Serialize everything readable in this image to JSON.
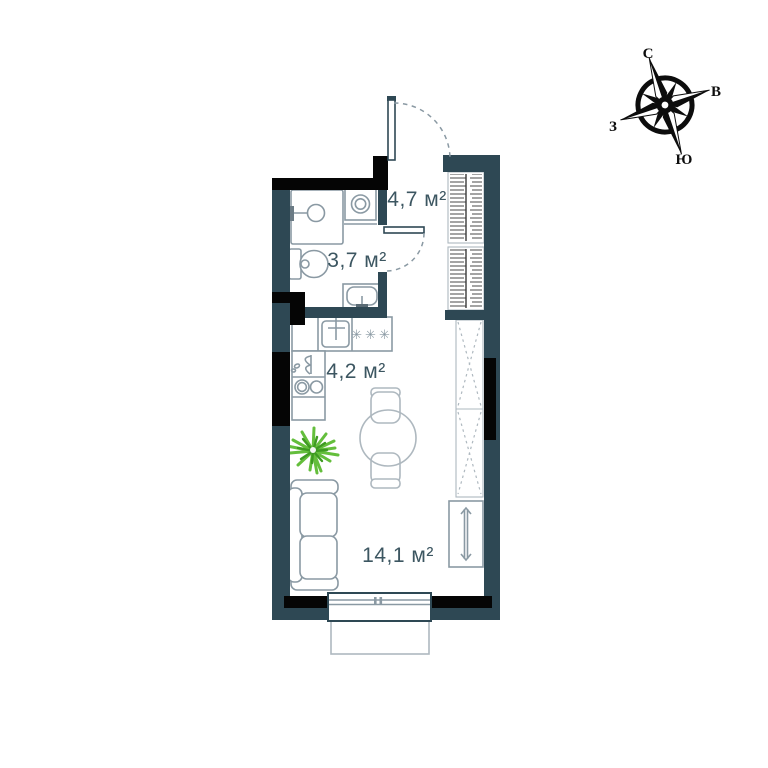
{
  "colors": {
    "wall": "#2E4854",
    "wallblack": "#050505",
    "furniture": "#8A99A3",
    "furniturelight": "#AEB8BF",
    "text": "#3C5661",
    "plant": "#64BE3C",
    "plantdark": "#3E9A22",
    "compass": "#0D0D0D"
  },
  "rooms": {
    "hallway": {
      "area": "4,7 м²"
    },
    "bathroom": {
      "area": "3,7 м²"
    },
    "kitchen": {
      "area": "4,2 м²"
    },
    "living": {
      "area": "14,1 м²"
    }
  },
  "kitchen_fixtures": {
    "burners": "✳✳✳"
  },
  "compass": {
    "north": "С",
    "east": "В",
    "south": "Ю",
    "west": "З"
  }
}
